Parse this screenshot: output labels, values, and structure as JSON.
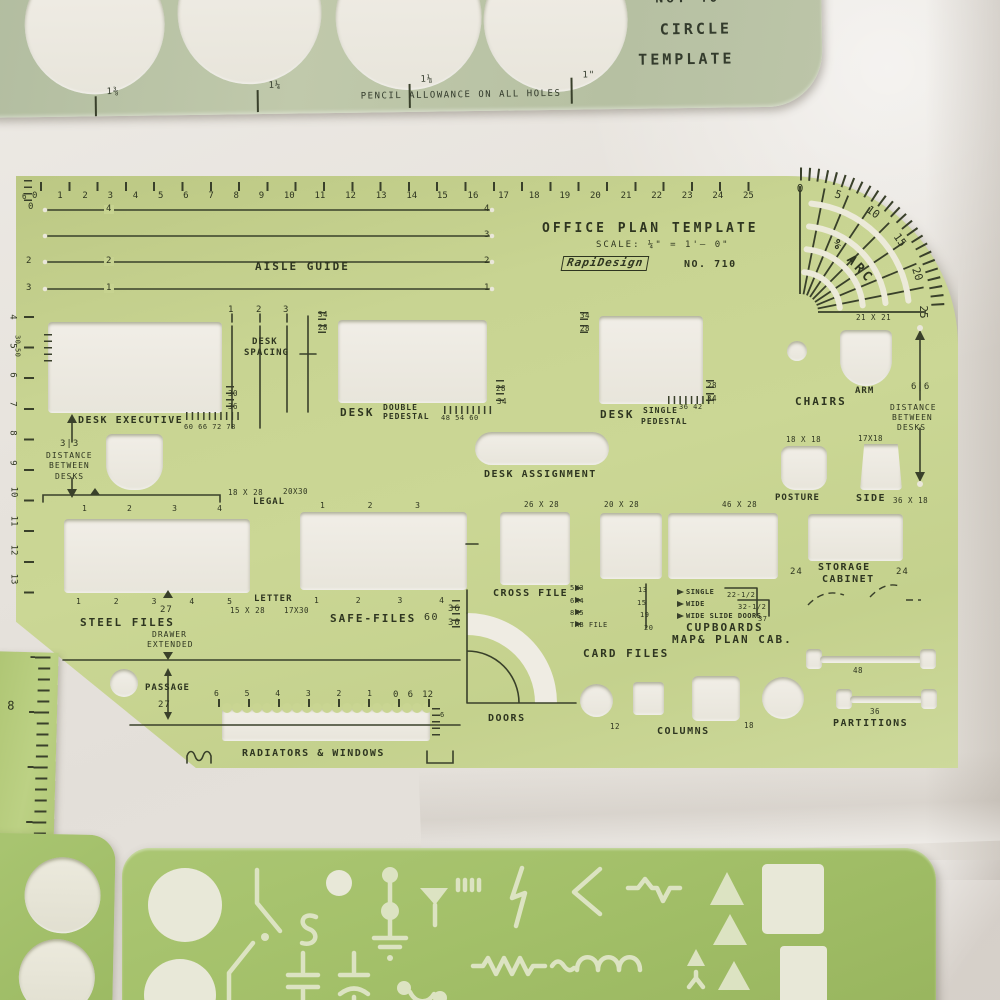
{
  "circle_template": {
    "model": "No. 40",
    "title_line1": "CIRCLE",
    "title_line2": "TEMPLATE",
    "note": "PENCIL ALLOWANCE ON ALL HOLES",
    "sizes": [
      "1⅜",
      "1¼",
      "1⅛",
      "1\""
    ]
  },
  "office": {
    "title": "OFFICE PLAN TEMPLATE",
    "scale_label": "SCALE: ¼\" = 1'– 0\"",
    "brand": "RapiDesign",
    "model": "NO. 710",
    "top_ruler_prefix": "6",
    "top_ruler": [
      "0",
      "1",
      "2",
      "3",
      "4",
      "5",
      "6",
      "7",
      "8",
      "9",
      "10",
      "11",
      "12",
      "13",
      "14",
      "15",
      "16",
      "17",
      "18",
      "19",
      "20",
      "21",
      "22",
      "23",
      "24",
      "25"
    ],
    "left_ruler": [
      "4",
      "5",
      "6",
      "7",
      "8",
      "9",
      "10",
      "11",
      "12",
      "13"
    ],
    "left_ruler_small": [
      "30",
      "50"
    ],
    "aisle": {
      "label": "AISLE GUIDE",
      "right": [
        "4",
        "3",
        "2",
        "1"
      ],
      "left": [
        "0",
        "2",
        "3"
      ],
      "inline": [
        "4",
        "2",
        "1"
      ]
    },
    "arc": {
      "label": "% ARC",
      "ticks": [
        "0",
        "5",
        "10",
        "15",
        "20",
        "25"
      ],
      "size": "21 X 21"
    },
    "desk_spacing": {
      "line1": "DESK",
      "line2": "SPACING",
      "marks": [
        "1",
        "2",
        "3"
      ]
    },
    "desk_executive": {
      "label": "DESK EXECUTIVE",
      "bottom": "60 66 72 78",
      "side_top": "30",
      "side_bottom": "36"
    },
    "desk_double": {
      "label": "DESK",
      "type1": "DOUBLE",
      "type2": "PEDESTAL",
      "bottom": "48 54 60",
      "left_top": "34",
      "left_bottom": "28",
      "right_top": "28",
      "right_bottom": "34"
    },
    "desk_single": {
      "label": "DESK",
      "type1": "SINGLE",
      "type2": "PEDESTAL",
      "bottom": "36 42",
      "left_top": "34",
      "left_bottom": "28",
      "right_top": "28",
      "right_bottom": "34"
    },
    "dist_left": {
      "value": "3|3",
      "l1": "DISTANCE",
      "l2": "BETWEEN",
      "l3": "DESKS"
    },
    "dist_right": {
      "value": "6|6",
      "l1": "DISTANCE",
      "l2": "BETWEEN",
      "l3": "DESKS"
    },
    "chairs": {
      "label": "CHAIRS",
      "arm": "ARM",
      "posture": "POSTURE",
      "posture_size": "18 X 18",
      "side": "SIDE",
      "side_size": "17X18"
    },
    "desk_assignment": "DESK ASSIGNMENT",
    "legal": {
      "size1": "18 X 28",
      "size2": "20X30",
      "label": "LEGAL"
    },
    "letter": {
      "label": "LETTER",
      "size1": "15 X 28",
      "size2": "17X30"
    },
    "steel_files": {
      "label": "STEEL FILES",
      "top_marks": [
        "1",
        "2",
        "3",
        "4"
      ],
      "bottom_marks": [
        "1",
        "2",
        "3",
        "4",
        "5"
      ],
      "value": "27",
      "drawer1": "DRAWER",
      "drawer2": "EXTENDED"
    },
    "safe_files": {
      "label": "SAFE-FILES",
      "value": "60",
      "top_marks": [
        "1",
        "2",
        "3"
      ],
      "bottom_marks": [
        "1",
        "2",
        "3",
        "4"
      ],
      "side_top": "36",
      "side_bottom": "30"
    },
    "cross_file": {
      "size": "26 X 28",
      "label": "CROSS FILE"
    },
    "file_b": "20 X 28",
    "file_c": "46 X 28",
    "card_files": {
      "label": "CARD FILES",
      "rows": [
        [
          "5X3",
          "13"
        ],
        [
          "6X4",
          "15"
        ],
        [
          "8X5",
          "19"
        ],
        [
          "TAB FILE",
          "20"
        ]
      ]
    },
    "cupboards": {
      "rows": [
        [
          "SINGLE",
          "22-1/2"
        ],
        [
          "WIDE",
          "32-1/2"
        ],
        [
          "WIDE SLIDE DOORS",
          "37"
        ]
      ],
      "label1": "CUPBOARDS",
      "label2": "MAP& PLAN CAB."
    },
    "storage": {
      "l1": "STORAGE",
      "l2": "CABINET",
      "left": "24",
      "right": "24",
      "size": "36 X 18"
    },
    "doors": "DOORS",
    "columns": {
      "label": "COLUMNS",
      "v1": "12",
      "v2": "18"
    },
    "partitions": {
      "label": "PARTITIONS",
      "v1": "48",
      "v2": "36"
    },
    "passage": {
      "label": "PASSAGE",
      "value": "27"
    },
    "radiators": {
      "label": "RADIATORS & WINDOWS",
      "scale_major": [
        "6",
        "5",
        "4",
        "3",
        "2",
        "1"
      ],
      "scale_minor": [
        "0",
        "6",
        "12"
      ],
      "side": "6"
    }
  },
  "side_ruler": {
    "value": "8"
  }
}
